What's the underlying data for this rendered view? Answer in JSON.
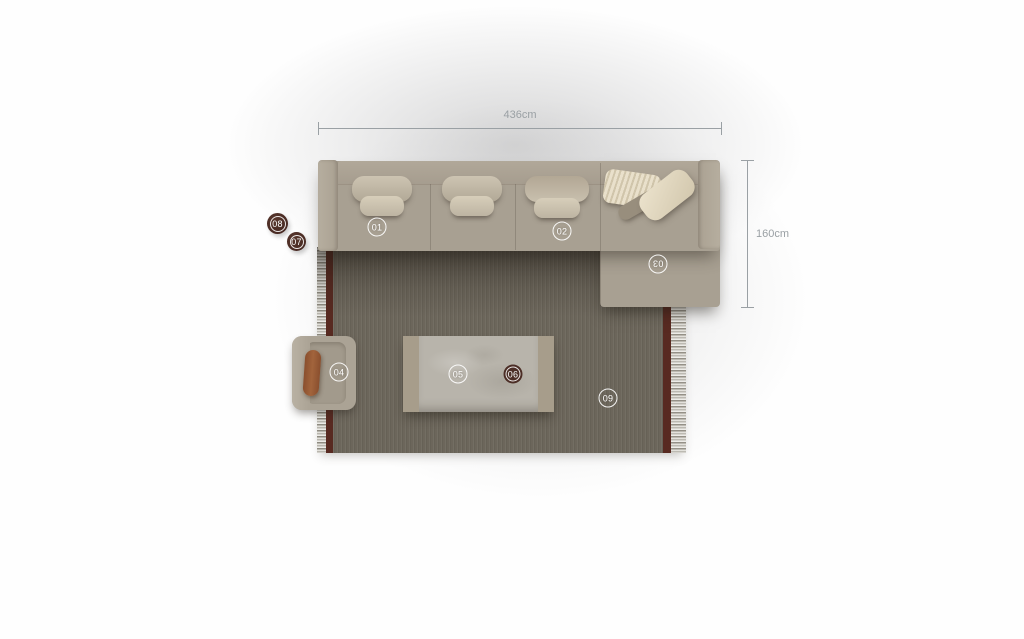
{
  "dimension_annotations": {
    "horizontal": {
      "label": "436cm"
    },
    "vertical": {
      "label": "160cm"
    }
  },
  "markers": [
    {
      "id": "01",
      "label": "01",
      "style": "outline",
      "placed_on": "sofa-seat-section-left"
    },
    {
      "id": "02",
      "label": "02",
      "style": "outline",
      "placed_on": "sofa-seat-section-right"
    },
    {
      "id": "03",
      "label": "03",
      "style": "outline",
      "rotated": true,
      "placed_on": "chaise-section"
    },
    {
      "id": "04",
      "label": "04",
      "style": "outline",
      "placed_on": "armchair"
    },
    {
      "id": "05",
      "label": "05",
      "style": "outline",
      "placed_on": "coffee-table"
    },
    {
      "id": "06",
      "label": "06",
      "style": "filled",
      "placed_on": "coffee-table"
    },
    {
      "id": "07",
      "label": "07",
      "style": "filled",
      "placed_on": "side-table-small"
    },
    {
      "id": "08",
      "label": "08",
      "style": "filled",
      "placed_on": "side-table-large"
    },
    {
      "id": "09",
      "label": "09",
      "style": "outline",
      "placed_on": "rug"
    }
  ],
  "colors": {
    "sofa_fabric": "#a8a092",
    "sofa_armrest": "#b6ae9f",
    "sofa_back": "#b1a899",
    "cushion_light": "#cdc4b2",
    "cushion_mid": "#d7ceba",
    "chaise_pillow_cream": "#ece3cd",
    "chaise_pillow_striped": "#e9e0cb",
    "rug": "#6c665b",
    "rug_border": "#582a21",
    "rug_fringe": "#edece8",
    "table_stone": "#b8b4ab",
    "table_caps": "#a79d8b",
    "armchair_body": "#aba395",
    "armchair_throw": "#a2643c",
    "side_table": "#40241e",
    "marker_dark_fill": "#4c2e26",
    "marker_ring": "rgba(255,255,255,0.92)",
    "dimension_text": "#9aa0a4"
  }
}
